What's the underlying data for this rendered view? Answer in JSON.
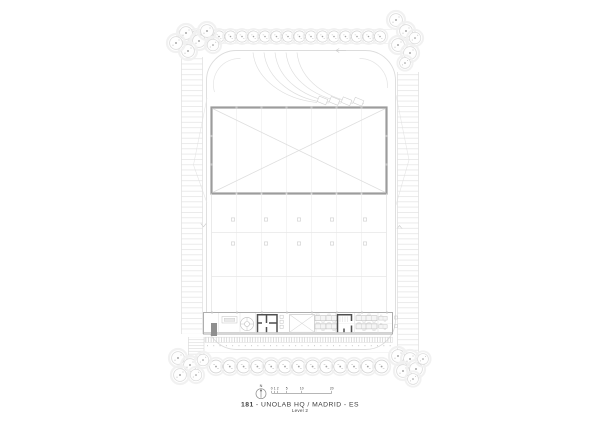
{
  "plan": {
    "title_number": "181",
    "title_rest": "- UNOLAB HQ / MADRID - ES",
    "level": "Level 2",
    "north_label": "N",
    "scale_labels": [
      "0",
      "1",
      "2",
      "5",
      "10",
      "20"
    ]
  },
  "colors": {
    "paper": "#ffffff",
    "line_faint": "#efefef",
    "line_light": "#dcdcdc",
    "line_mid": "#c0c0c0",
    "building_outline": "#9c9c9c",
    "wall_dark": "#4f4f4f",
    "fill_dark": "#8f8f8f",
    "text": "#3f3f3f"
  }
}
